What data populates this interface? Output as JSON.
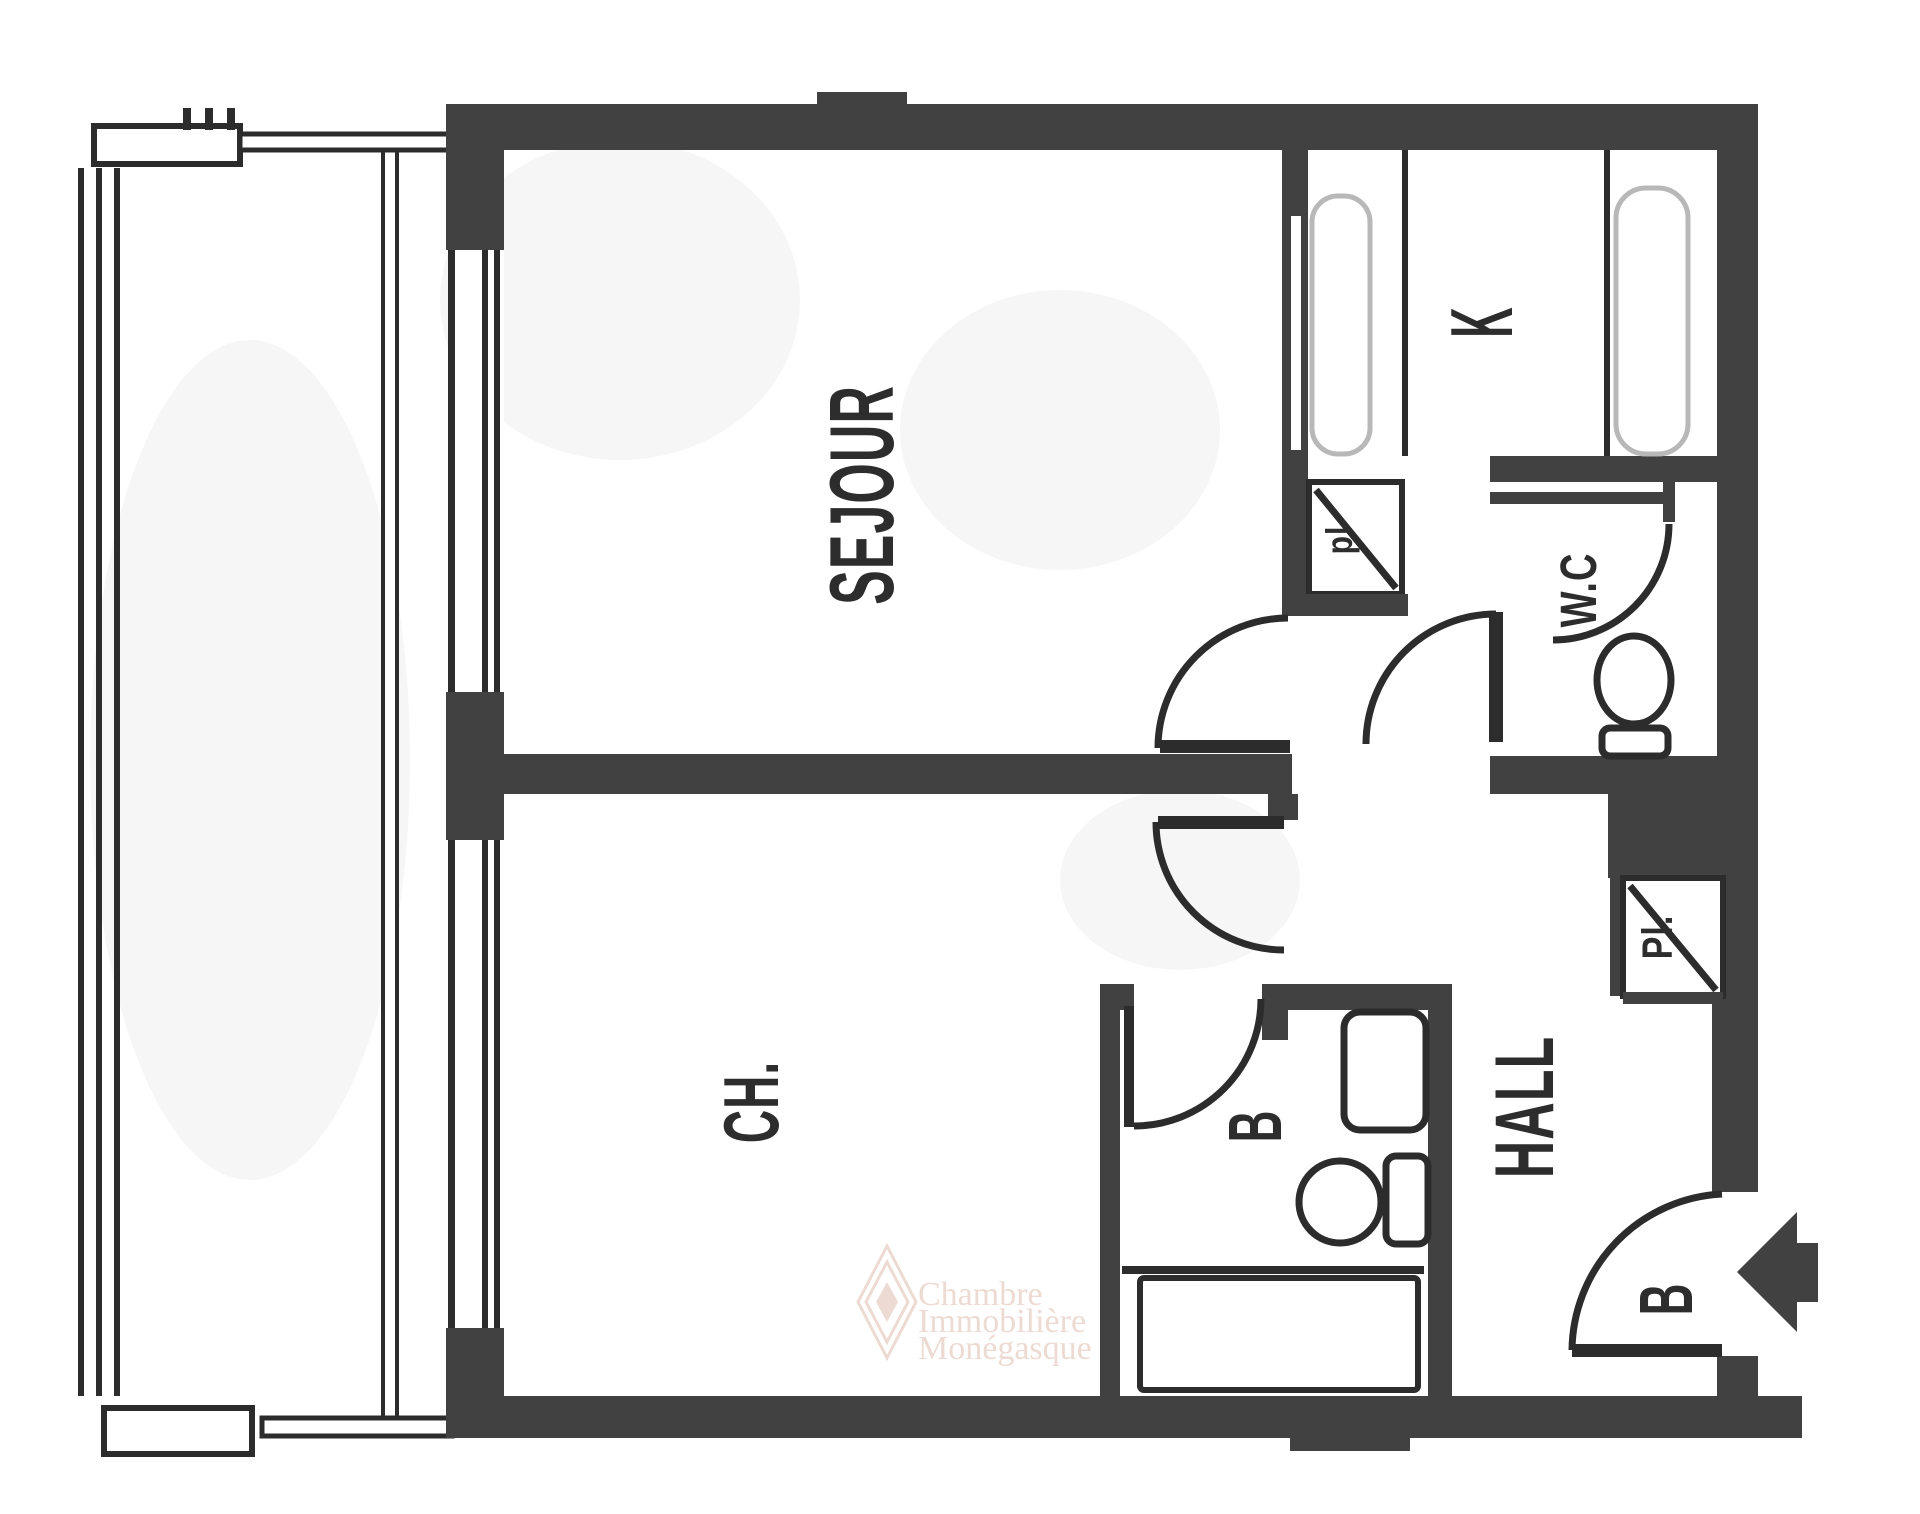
{
  "plan": {
    "title": "apartment-floor-plan",
    "rooms": {
      "sejour": {
        "label": "SEJOUR"
      },
      "kitchen": {
        "label": "K"
      },
      "wc": {
        "label": "W.C"
      },
      "hall": {
        "label": "HALL"
      },
      "bedroom": {
        "label": "CH."
      },
      "bathroom": {
        "label": "B"
      },
      "entry": {
        "label": "B"
      },
      "closet_kitchen": {
        "label": "pl"
      },
      "closet_hall": {
        "label": "Pl."
      }
    },
    "watermark": {
      "line1": "Chambre",
      "line2": "Immobilière",
      "line3": "Monégasque"
    },
    "colors": {
      "wall": "#414141",
      "line": "#2c2c2c",
      "text": "#2d2d2d",
      "watermark": "#eddbd3",
      "counter_outline": "#b8b8b8",
      "background": "#ffffff"
    }
  }
}
